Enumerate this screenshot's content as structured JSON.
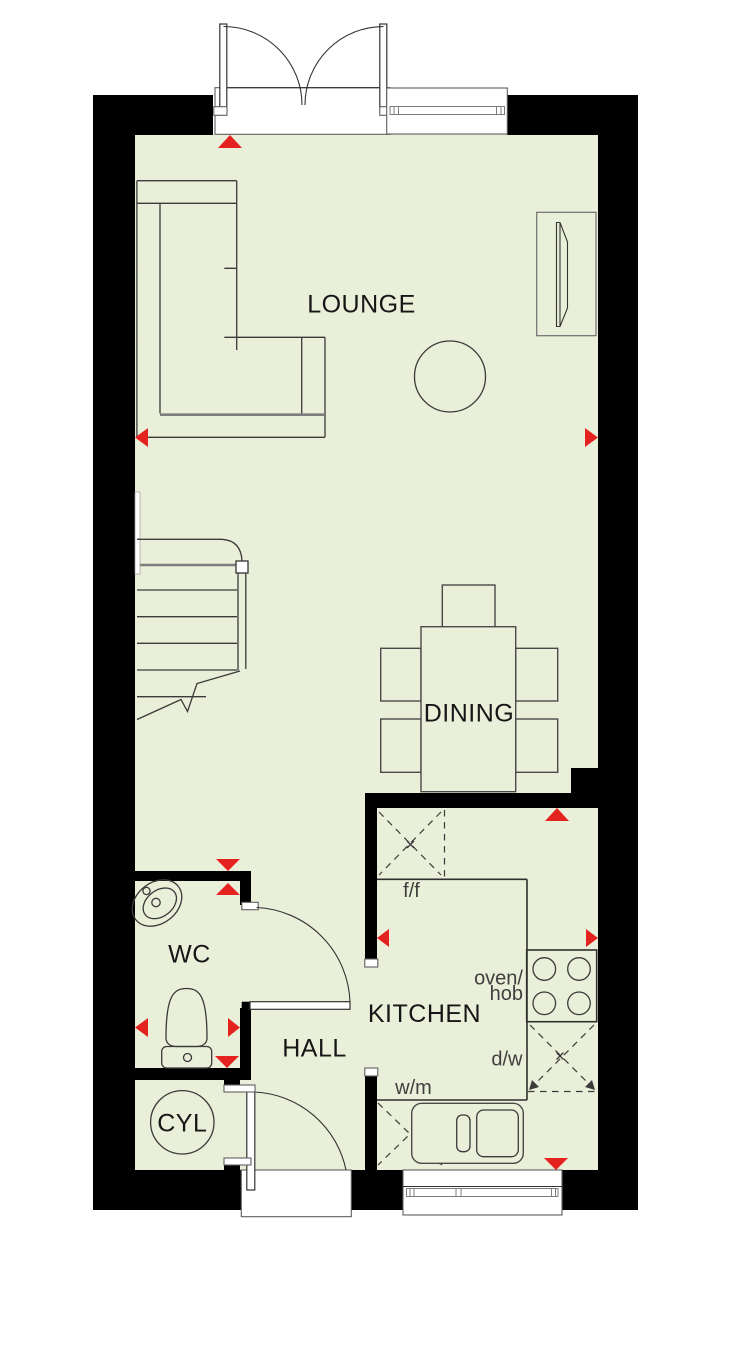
{
  "colors": {
    "floor": "#e9efd8",
    "wall": "#000000",
    "accent_red": "#e42320",
    "furniture_line": "#3a3a3a",
    "frame_line": "#5f5f5f",
    "label_dark": "#161616",
    "label_gray": "#3f3f3f",
    "outside": "#ffffff"
  },
  "rooms": {
    "lounge": {
      "label": "LOUNGE"
    },
    "dining": {
      "label": "DINING"
    },
    "kitchen": {
      "label": "KITCHEN"
    },
    "hall": {
      "label": "HALL"
    },
    "wc": {
      "label": "WC"
    },
    "cyl": {
      "label": "CYL"
    }
  },
  "appliances": {
    "fridge_freezer": {
      "label": "f/f"
    },
    "oven_hob": {
      "line1": "oven/",
      "line2": "hob"
    },
    "dishwasher": {
      "label": "d/w"
    },
    "washing_machine": {
      "label": "w/m"
    }
  }
}
